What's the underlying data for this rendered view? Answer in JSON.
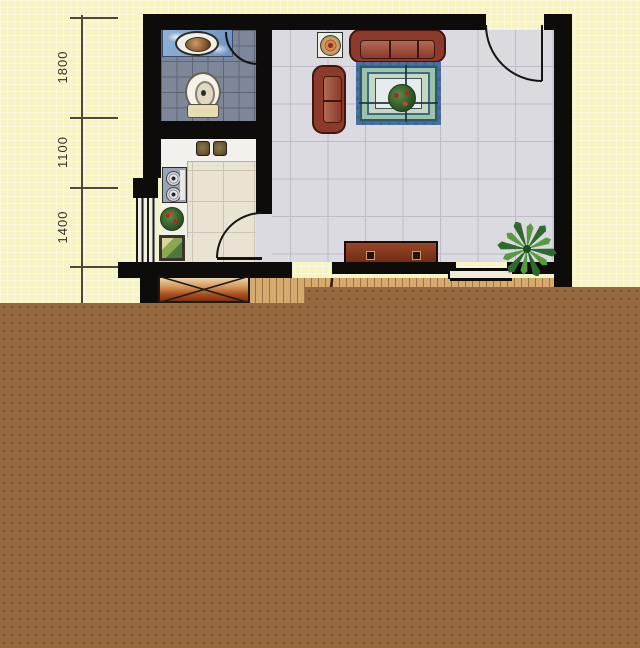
{
  "document": {
    "kind": "scanned apartment floor plan, watercolor style",
    "visible_text": [
      "1800",
      "1100",
      "1400"
    ]
  },
  "dimensions": {
    "orientation": "vertical chain on left side, labels rotated 90°",
    "labels": [
      {
        "value": "1800"
      },
      {
        "value": "1100"
      },
      {
        "value": "1400"
      }
    ]
  },
  "rooms": {
    "bathroom": {
      "floor": "dark slate-blue tile grid",
      "items": [
        "sink-counter with sky-blue top",
        "oval basin",
        "toilet"
      ]
    },
    "kitchen": {
      "floor": "beige tile grid",
      "items": [
        "double-bowl sink",
        "two-burner stove",
        "vegetable basket",
        "cutting-board / framed panel"
      ],
      "window": "louvered window on left wall"
    },
    "living_room": {
      "floor": "pale lavender-grey tile grid",
      "items": [
        "three-seat sofa",
        "two-seat sofa",
        "square side table with compass ornament",
        "patterned area rug with plant centerpiece",
        "tv cabinet with two knobs",
        "potted palm plant"
      ],
      "doors": [
        "entrance door top-right",
        "bathroom door",
        "kitchen door",
        "balcony door"
      ]
    },
    "balcony": {
      "floor": "wood planks",
      "window": "window strip in bottom wall"
    },
    "service_shaft": "hatched X box at bottom-left"
  },
  "colors": {
    "paper": "#f7f4c3",
    "wall": "#0d0c0a",
    "bath_floor": "#7e8799",
    "kitchen_floor": "#e9e3d3",
    "living_floor": "#dcdae1",
    "wood_floor": "#d4aa6f",
    "sofa": "#8d3a2b",
    "rug_band": "#9cc2ac",
    "rug_fringe": "#4a6fa8",
    "cabinet": "#7a3318",
    "shaft": "#a84c1c",
    "brown_obstruction": "#96693f"
  }
}
